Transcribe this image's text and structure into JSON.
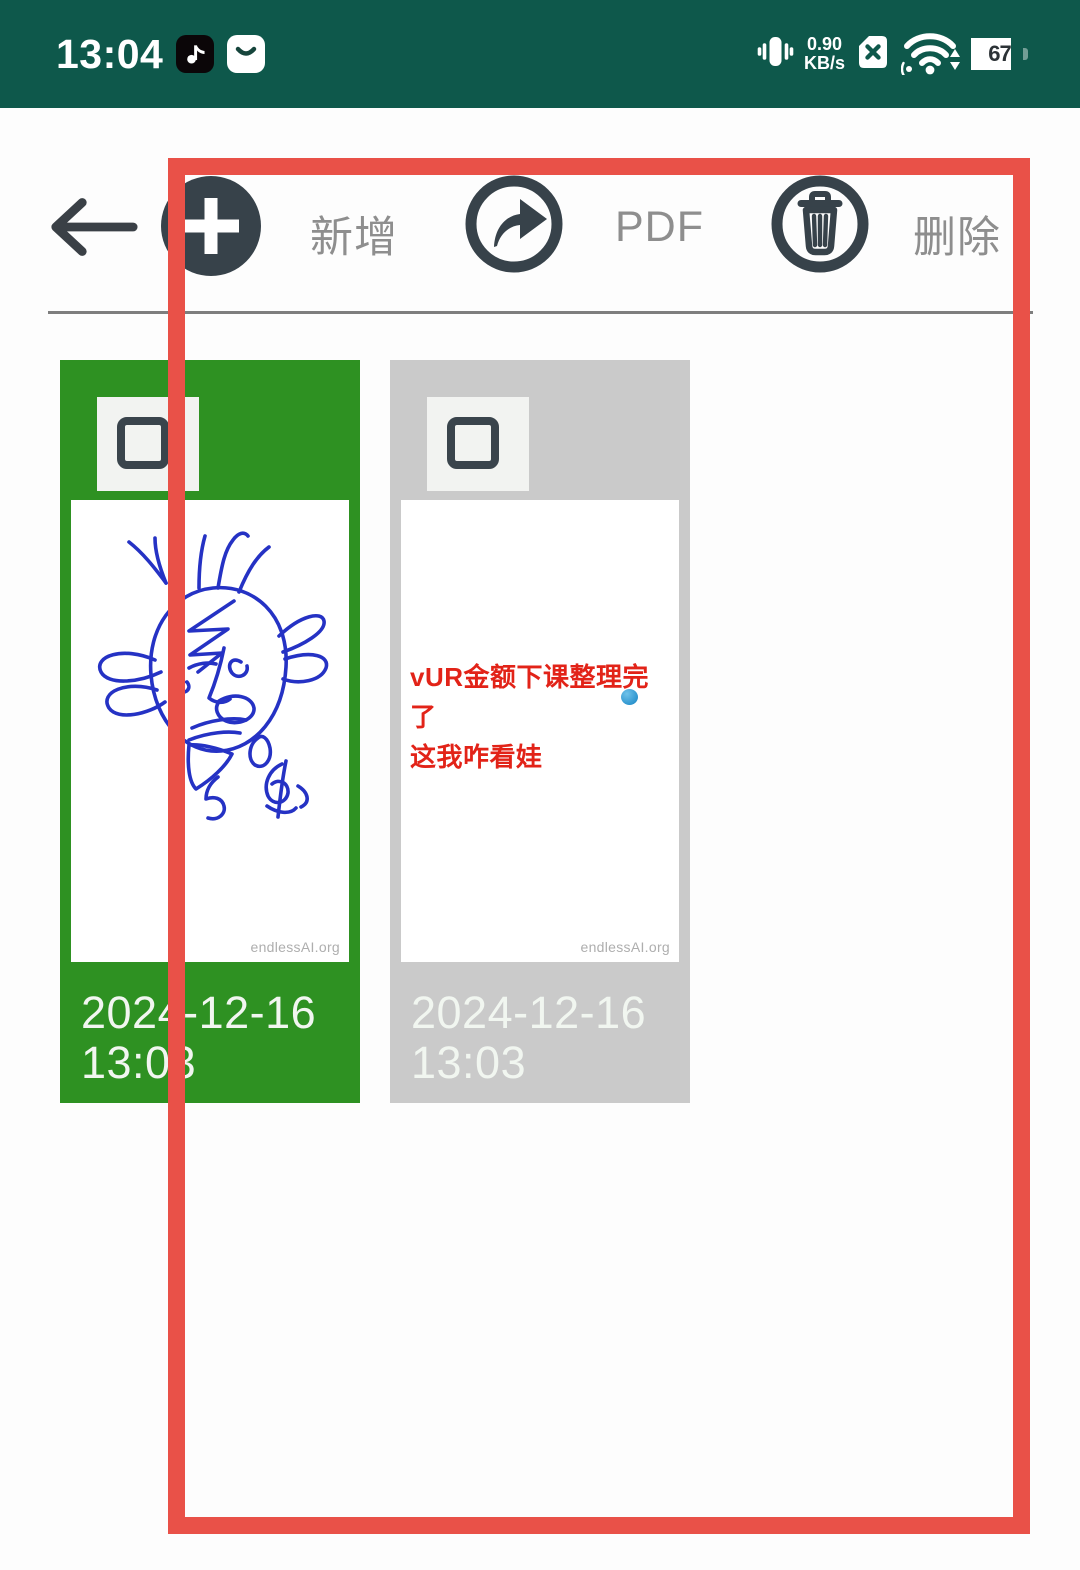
{
  "status_bar": {
    "time": "13:04",
    "network_speed": "0.90",
    "network_speed_unit": "KB/s",
    "battery_percent": "67"
  },
  "toolbar": {
    "add_label": "新增",
    "pdf_label": "PDF",
    "delete_label": "删除"
  },
  "documents": [
    {
      "date": "2024-12-16",
      "time": "13:03",
      "watermark": "endlessAI.org",
      "selected": true
    },
    {
      "date": "2024-12-16",
      "time": "13:03",
      "watermark": "endlessAI.org",
      "note_line1": "vUR金额下课整理完了",
      "note_line2": "这我咋看娃",
      "selected": false
    }
  ],
  "colors": {
    "statusbar": "#0E584B",
    "card_selected_green": "#2E9122",
    "card_gray": "#CACACA",
    "annotation_red": "#E95148",
    "note_red": "#E22318",
    "doodle_blue": "#2532C4",
    "icon_dark": "#37424A",
    "label_gray": "#8E8E8E"
  }
}
